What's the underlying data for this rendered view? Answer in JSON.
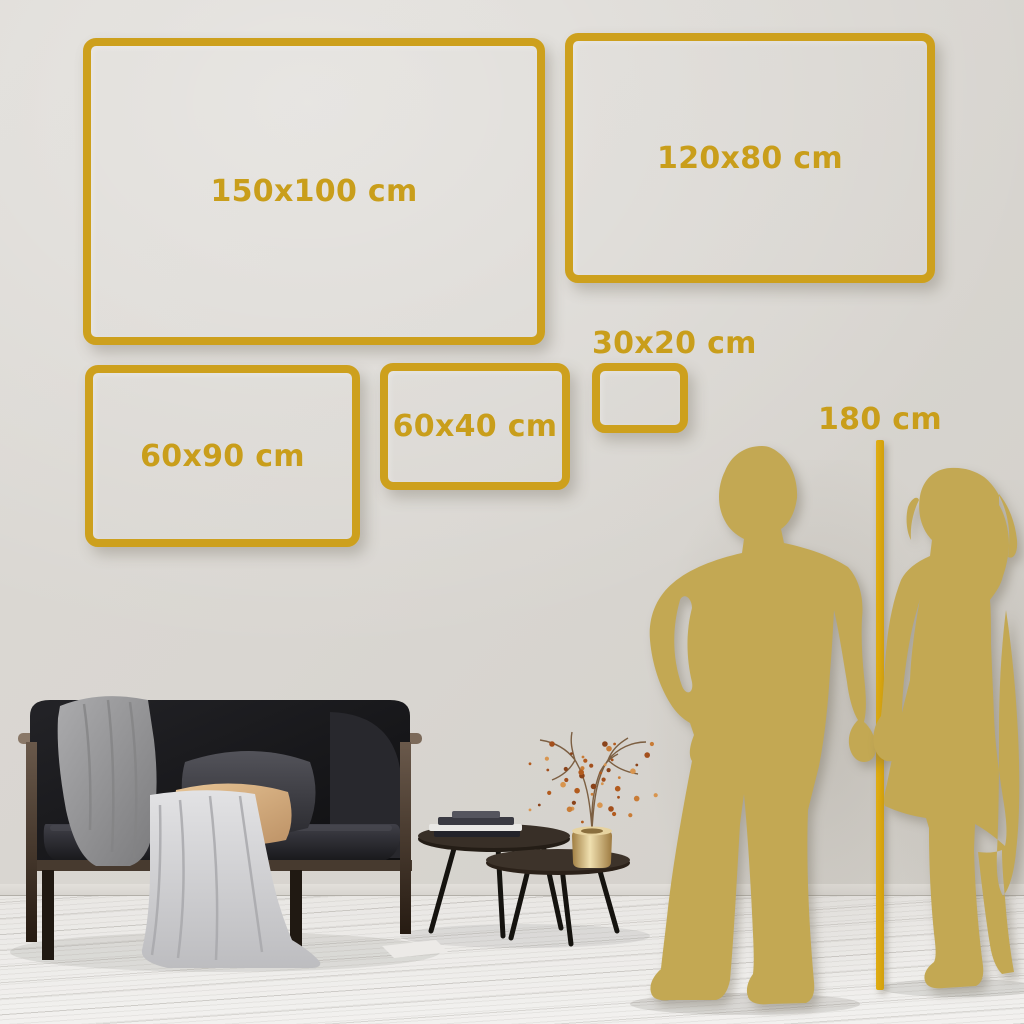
{
  "scene": {
    "description": "Wall-art size guide mockup with gold frames, couple silhouette height reference, sofa and coffee tables"
  },
  "sizes": {
    "frames": [
      {
        "id": "150x100",
        "label": "150x100 cm"
      },
      {
        "id": "120x80",
        "label": "120x80 cm"
      },
      {
        "id": "60x90",
        "label": "60x90 cm"
      },
      {
        "id": "60x40",
        "label": "60x40 cm"
      },
      {
        "id": "30x20",
        "label": "30x20 cm"
      }
    ],
    "height_reference": {
      "label": "180 cm"
    }
  },
  "colors": {
    "frame_gold": "#cda01d",
    "label_gold": "#c99e1b",
    "line_gold": "#d7a511",
    "silhouette_gold": "#c3a853",
    "wall": "#d9d6d1",
    "floor": "#eceae7",
    "sofa_dark": "#141417",
    "pillow_tan": "#d9b183"
  }
}
